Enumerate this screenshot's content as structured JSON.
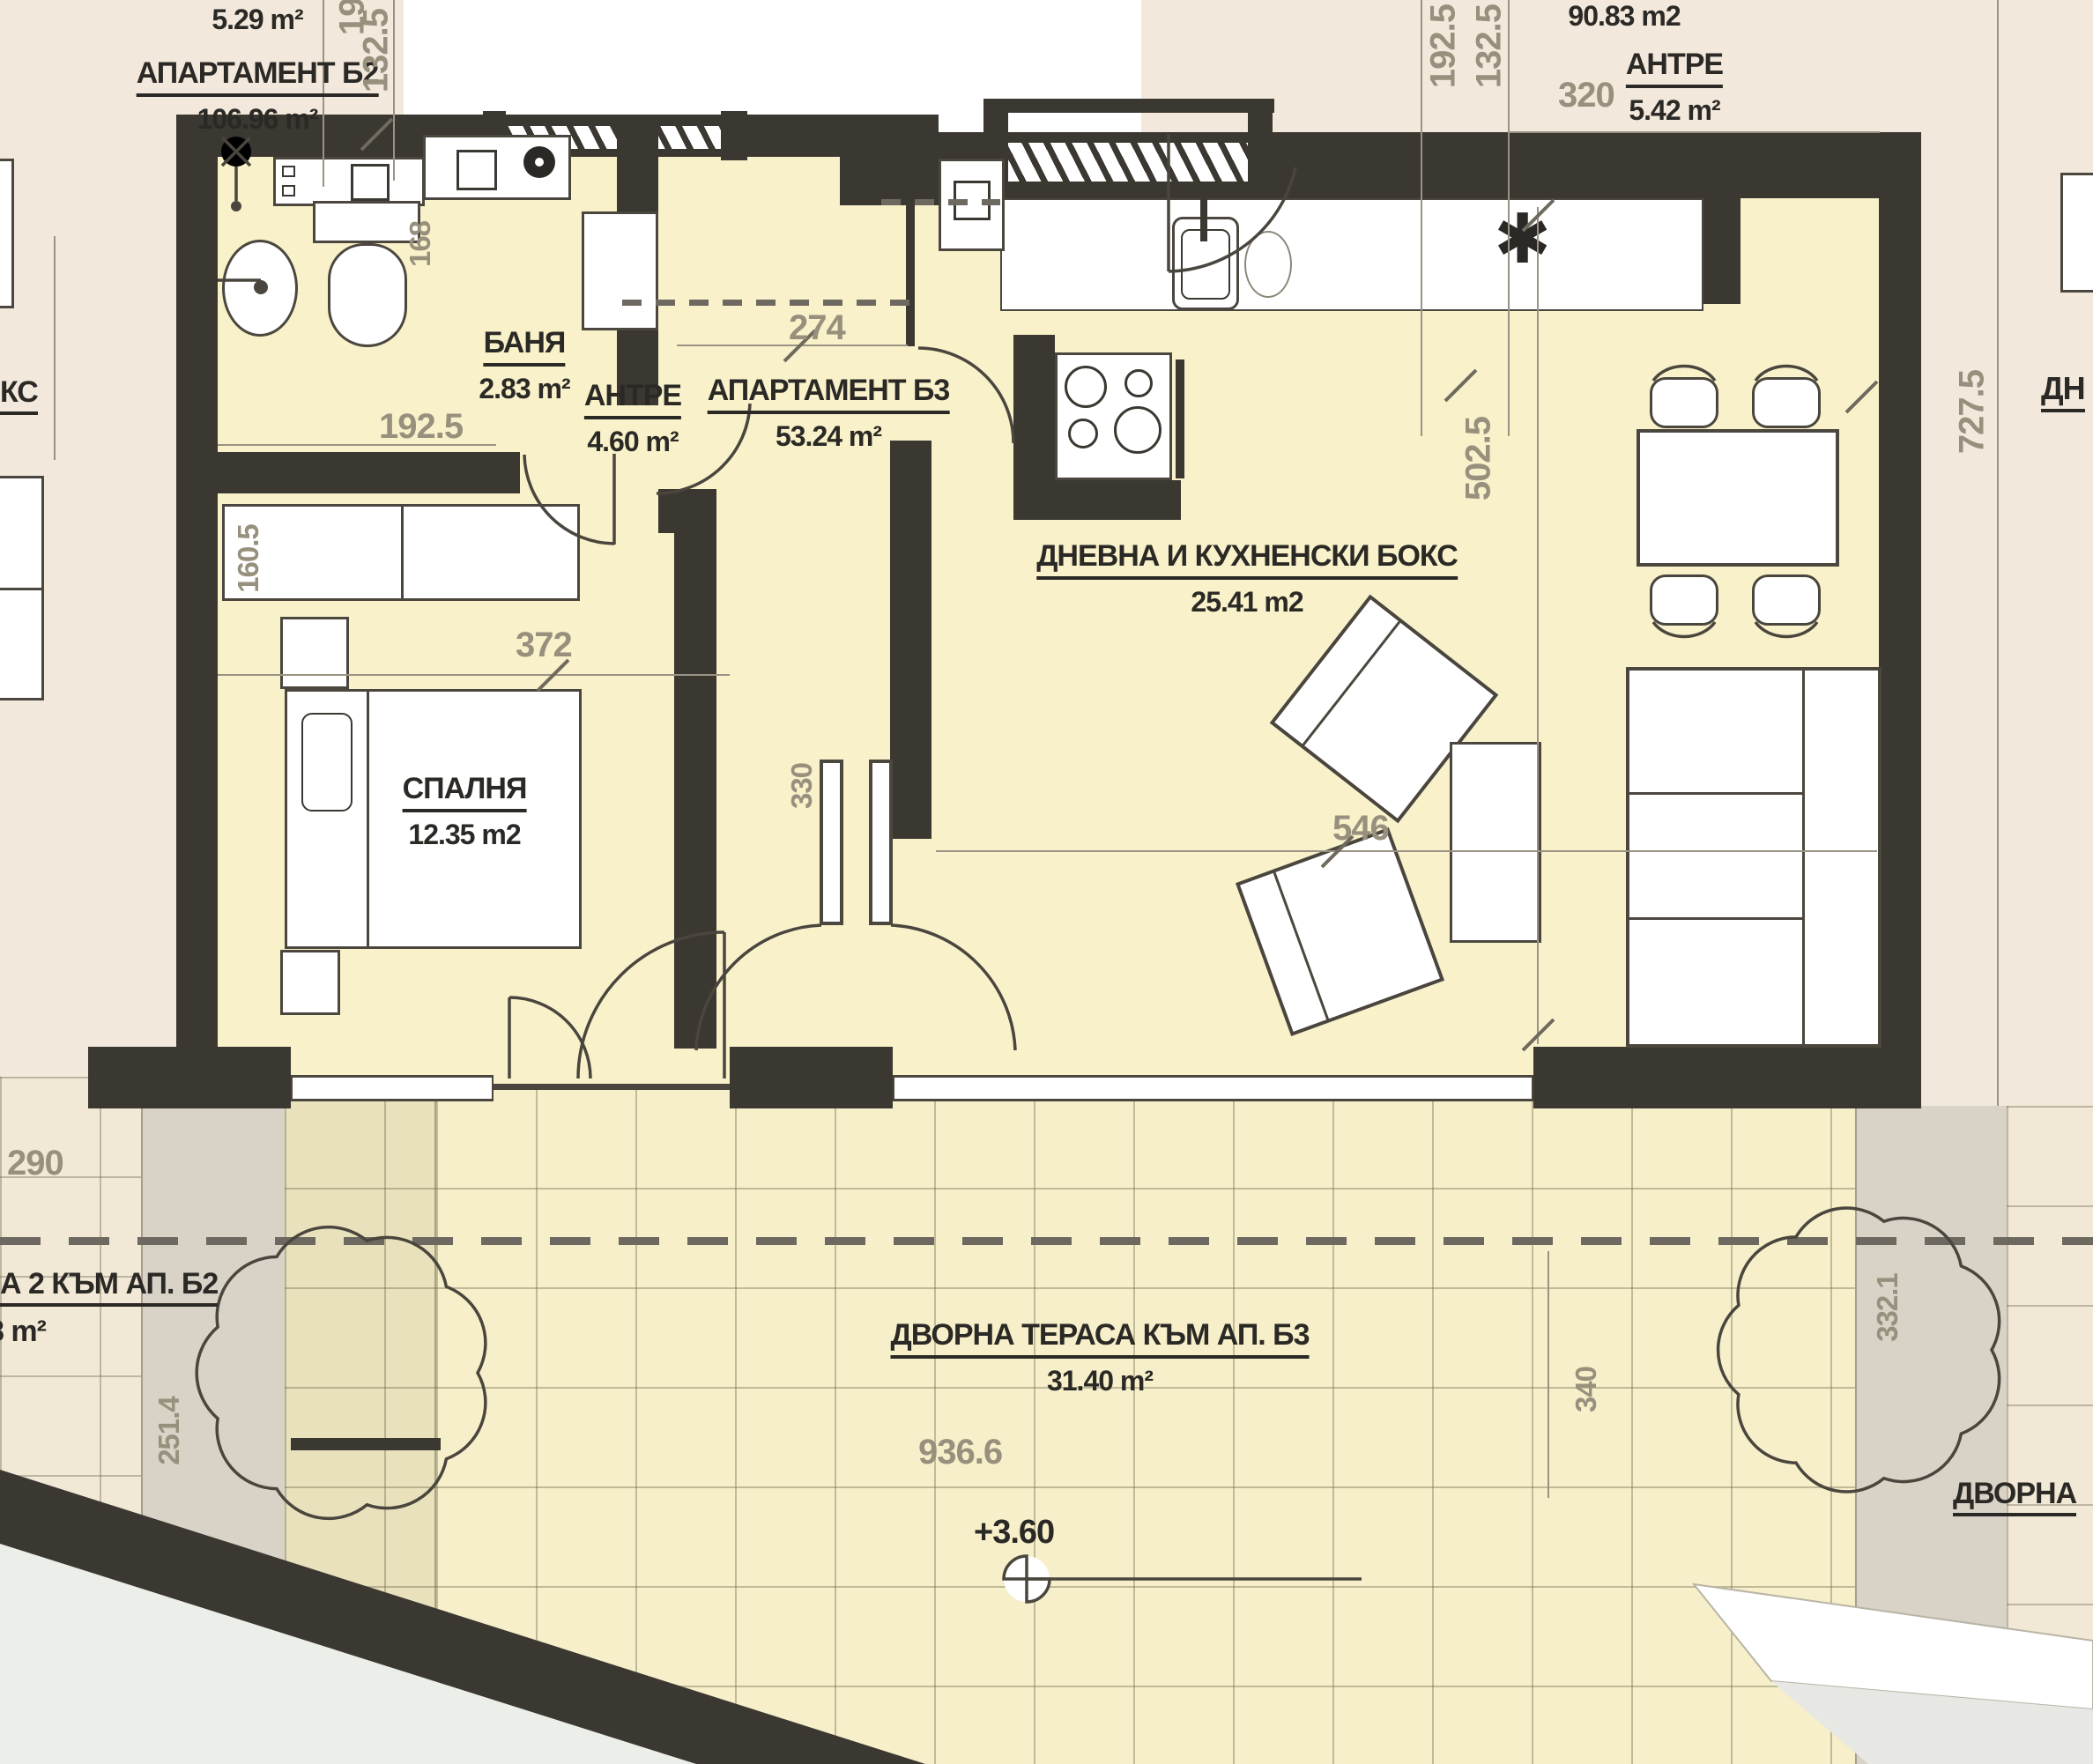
{
  "plan": {
    "title_context": "apartment floor plan",
    "rooms": [
      {
        "name": "БАНЯ",
        "area": "2.83 m²"
      },
      {
        "name": "АНТРЕ",
        "area": "4.60 m²"
      },
      {
        "name": "АПАРТАМЕНТ Б3",
        "area": "53.24 m²"
      },
      {
        "name": "ДНЕВНА И КУХНЕНСКИ БОКС",
        "area": "25.41 m2"
      },
      {
        "name": "СПАЛНЯ",
        "area": "12.35 m2"
      },
      {
        "name": "ДВОРНА ТЕРАСА КЪМ АП. Б3",
        "area": "31.40 m²"
      }
    ],
    "neighbors": {
      "b2": {
        "area_small": "5.29 m²",
        "name": "АПАРТАМЕНТ Б2",
        "area": "106.96 m²"
      },
      "hall_top": {
        "area_total": "90.83 m2",
        "name": "АНТРЕ",
        "area": "5.42 m²"
      },
      "b2_terrace": {
        "name": "А 2 КЪМ АП. Б2",
        "area": "8 m²"
      },
      "cut_left": "КС",
      "cut_right": "ДН",
      "cut_bottom_right": "ДВОРНА"
    },
    "dims": [
      {
        "v": "192.5"
      },
      {
        "v": "132.5"
      },
      {
        "v": "160.5"
      },
      {
        "v": "192.5"
      },
      {
        "v": "168"
      },
      {
        "v": "274"
      },
      {
        "v": "372"
      },
      {
        "v": "330"
      },
      {
        "v": "192.5"
      },
      {
        "v": "132.5"
      },
      {
        "v": "320"
      },
      {
        "v": "502.5"
      },
      {
        "v": "546"
      },
      {
        "v": "727.5"
      },
      {
        "v": "936.6"
      },
      {
        "v": "340"
      },
      {
        "v": "290"
      },
      {
        "v": "251.4"
      },
      {
        "v": "332.1"
      }
    ],
    "elevation": "+3.60",
    "symbols": {
      "appliance_asterisk": "✱"
    },
    "colors": {
      "wall": "#3b3831",
      "interior": "#f8f1ca",
      "neighbor": "#f2e9dc",
      "terrace_tile": "#f6efc9",
      "dim_text": "#97907d"
    }
  }
}
